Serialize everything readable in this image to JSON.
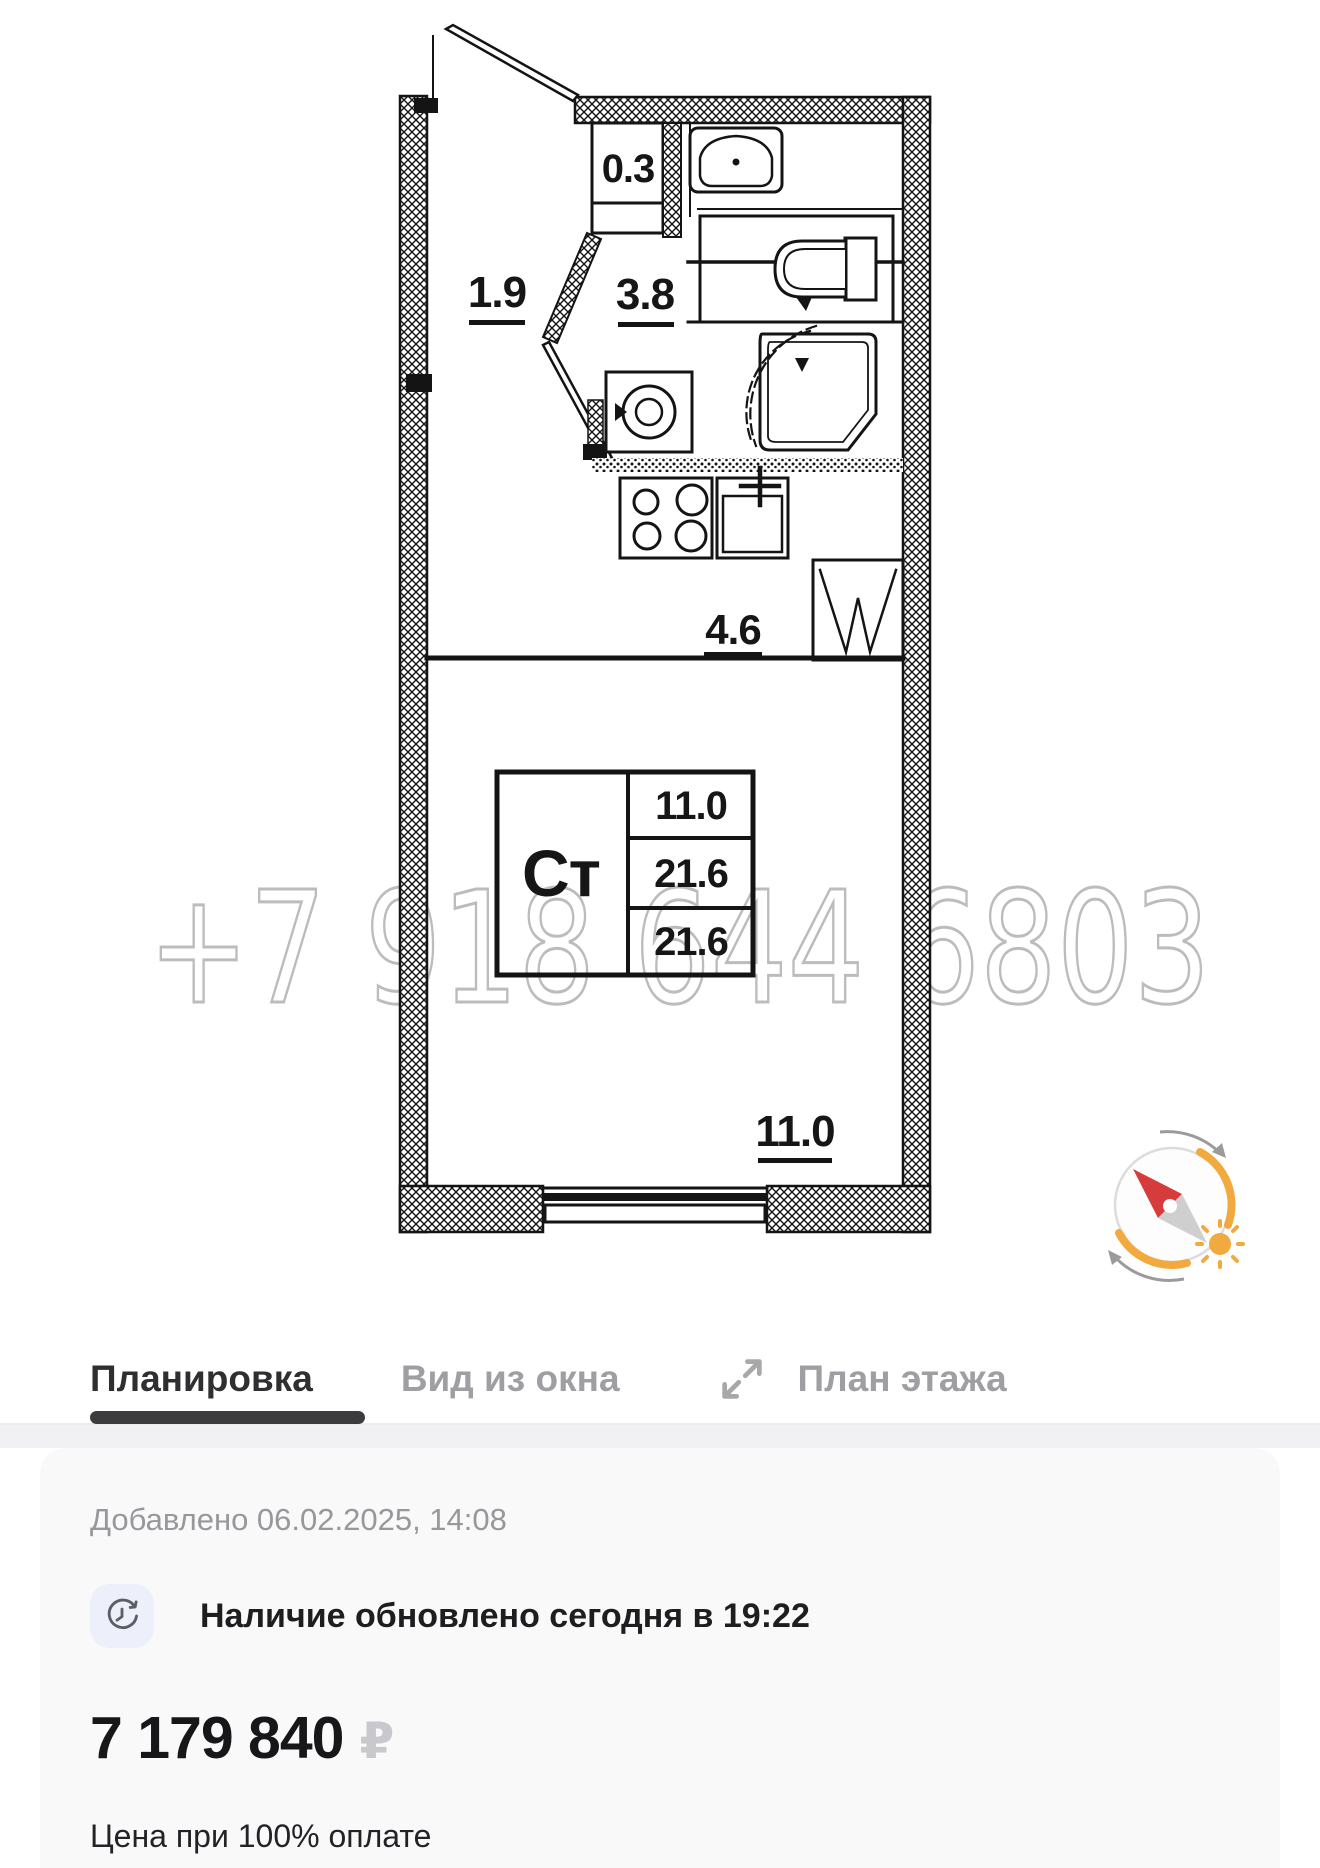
{
  "plan": {
    "watermark_phone": "+7 918 644 6803",
    "labels": {
      "hall": "1.9",
      "closet": "0.3",
      "bathroom": "3.8",
      "kitchen": "4.6",
      "room": "11.0"
    },
    "spec_table": {
      "type_label": "Ст",
      "values": [
        "11.0",
        "21.6",
        "21.6"
      ]
    }
  },
  "tabs": [
    {
      "label": "Планировка",
      "active": true
    },
    {
      "label": "Вид из окна",
      "active": false
    },
    {
      "label": "План этажа",
      "active": false
    }
  ],
  "card": {
    "added": "Добавлено 06.02.2025, 14:08",
    "availability": "Наличие обновлено сегодня в 19:22",
    "price": "7 179 840",
    "currency_symbol": "₽",
    "price_note": "Цена при 100% оплате"
  },
  "icons": {
    "expand": "expand-diagonal-arrows",
    "availability": "clock-refresh",
    "compass": "compass-needle-with-sun"
  },
  "colors": {
    "accent_orange": "#F2A93D",
    "needle_red": "#D63C3C",
    "tab_active": "#2F2F31",
    "tab_inactive": "#9F9FA3",
    "price_currency": "#C8C8CD",
    "watermark": "#BCBCBC"
  }
}
